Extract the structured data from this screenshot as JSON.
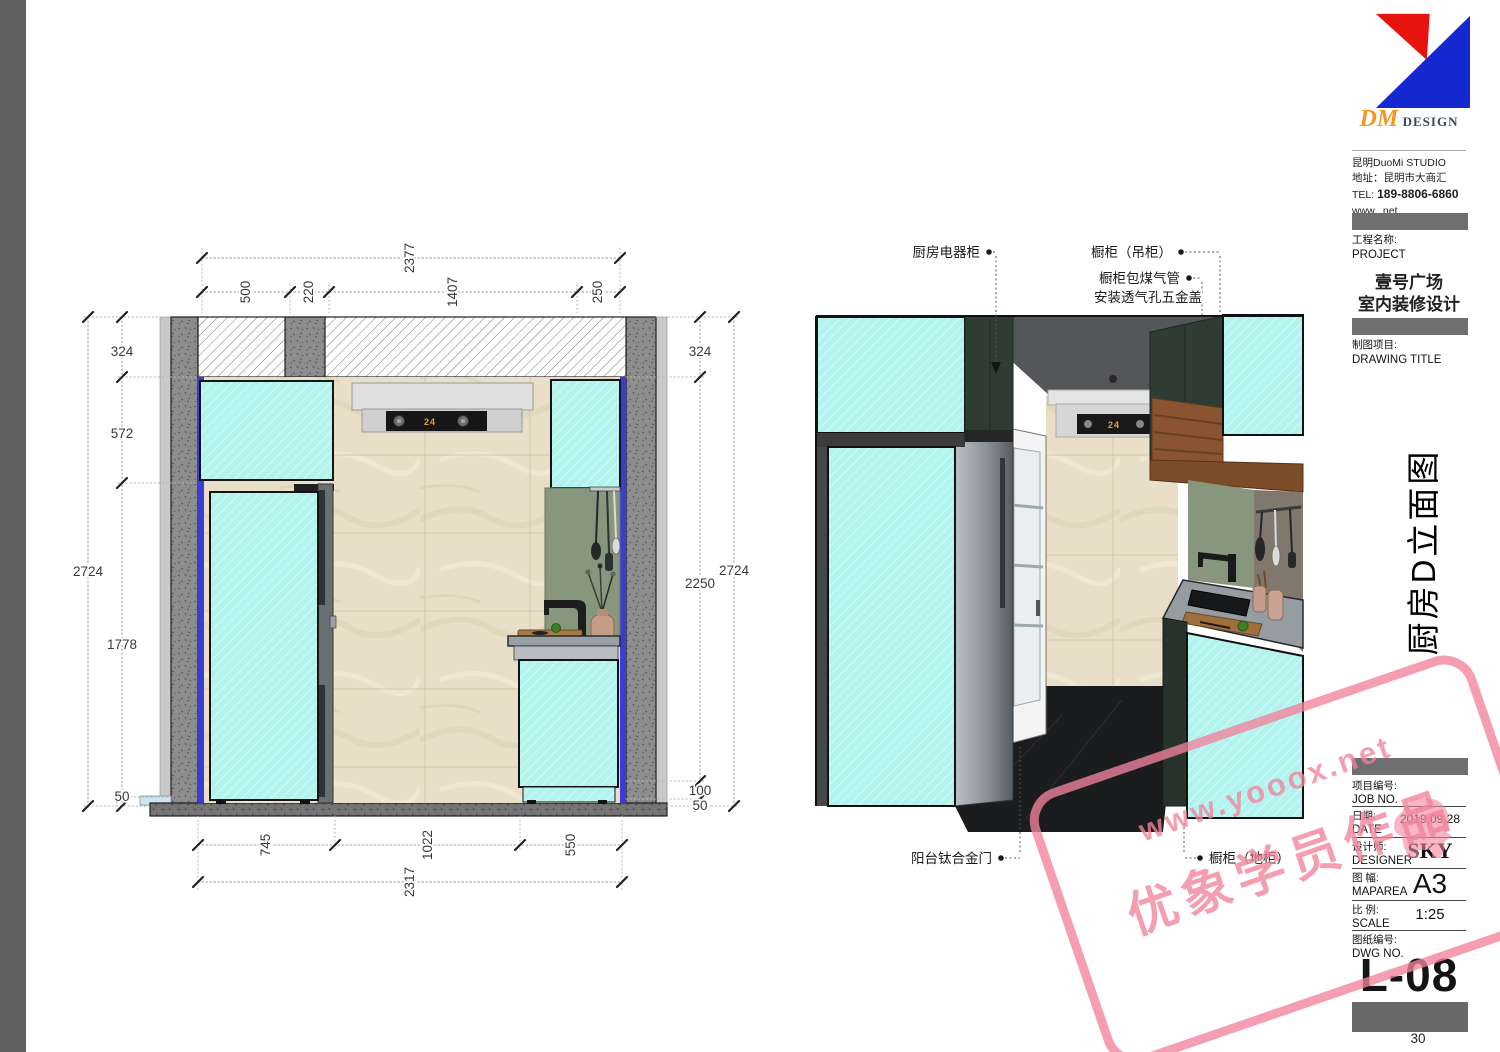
{
  "document": {
    "page_number": "30"
  },
  "brand": {
    "logo_dm": "DM",
    "logo_design": "DESIGN",
    "studio": "昆明DuoMi STUDIO",
    "address": "地址：昆明市大商汇",
    "tel_label": "TEL:",
    "tel": "189-8806-6860",
    "web": "www. .net"
  },
  "titleblock": {
    "project_label_cn": "工程名称:",
    "project_label_en": "PROJECT",
    "project_name_line1": "壹号广场",
    "project_name_line2": "室内装修设计",
    "drawing_label_cn": "制图项目:",
    "drawing_label_en": "DRAWING TITLE",
    "drawing_title_vertical": "厨房D立面图",
    "job_label_cn": "项目编号:",
    "job_label_en": "JOB NO.",
    "date_label_cn": "日期:",
    "date_label_en": "DATE",
    "date_value": "2019,09,28",
    "designer_label_cn": "设计师:",
    "designer_label_en": "DESIGNER",
    "designer_value": "SKY",
    "size_label_cn": "图 幅:",
    "size_label_en": "MAPAREA",
    "size_value": "A3",
    "scale_label_cn": "比 例:",
    "scale_label_en": "SCALE",
    "scale_value": "1:25",
    "dwg_label_cn": "图纸编号:",
    "dwg_label_en": "DWG NO.",
    "dwg_value": "L-08"
  },
  "elevation": {
    "dims_top_overall": "2377",
    "dims_top": [
      "500",
      "220",
      "1407",
      "250"
    ],
    "dims_left_overall": "2724",
    "dims_left": [
      "324",
      "572",
      "1778",
      "50"
    ],
    "dims_right_overall": "2724",
    "dims_right": [
      "324",
      "2250",
      "100",
      "50"
    ],
    "dims_bottom": [
      "745",
      "1022",
      "550"
    ],
    "dims_bottom_overall": "2317",
    "hood_display": "24"
  },
  "perspective": {
    "labels": {
      "appliance_cabinet": "厨房电器柜",
      "wall_cabinet": "橱柜（吊柜）",
      "gas_line1": "橱柜包煤气管",
      "gas_line2": "安装透气孔五金盖",
      "balcony_door": "阳台钛合金门",
      "base_cabinet": "橱柜（地柜）"
    },
    "hood_display": "24"
  },
  "watermark": {
    "line1": "www.yooox.net",
    "line2": "优象学员作品"
  },
  "colors": {
    "highlight_cyan": "#b2f3ee",
    "wall_finish_blue": "#3b3bd8",
    "backsplash_green": "#87977e",
    "cabinet_dark_green": "#2e3c34",
    "wood_brown": "#7c4b27",
    "logo_red": "#e8130c",
    "logo_blue": "#1628cf",
    "dm_orange": "#f7941d",
    "watermark_pink": "#f2839b",
    "hood_display_amber": "#e3a23c"
  }
}
